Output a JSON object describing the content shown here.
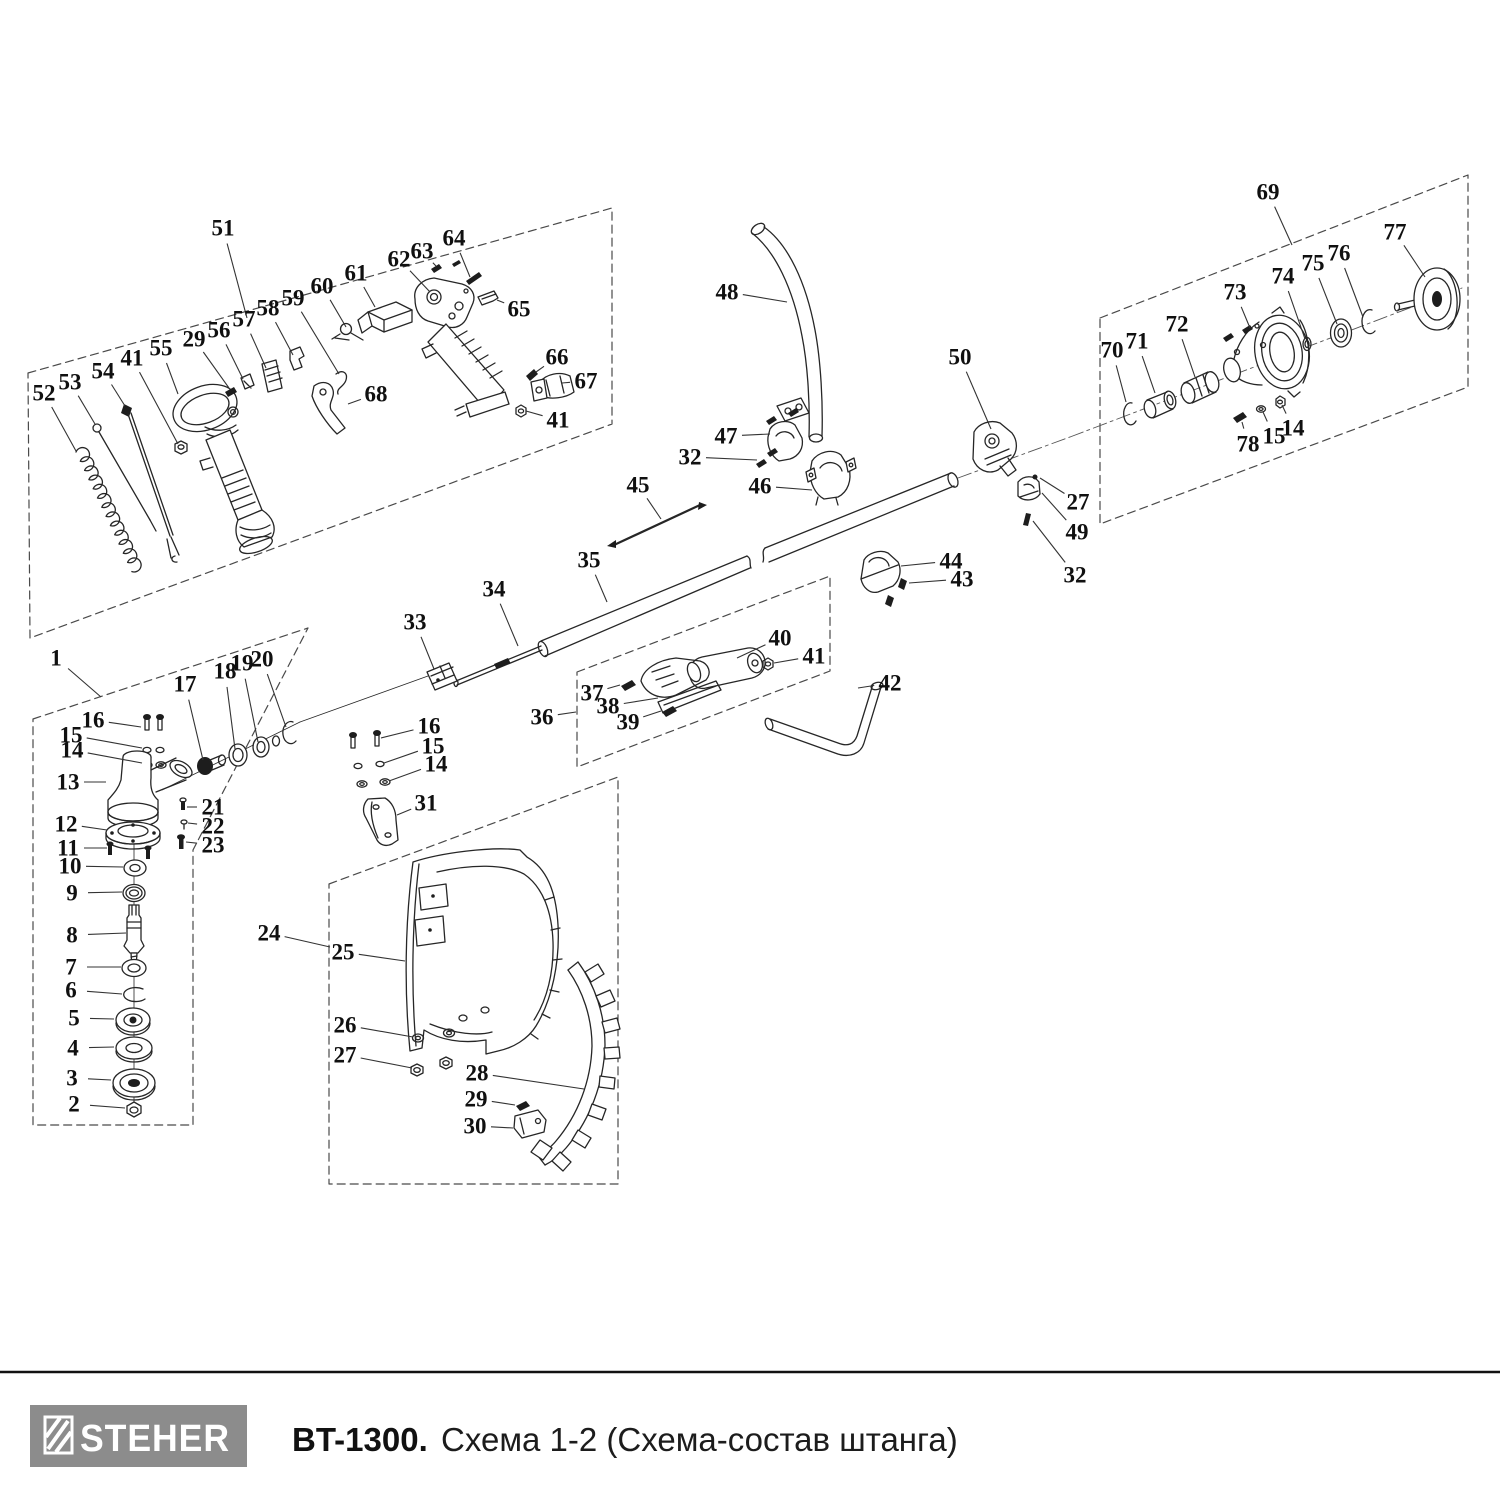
{
  "footer": {
    "brand": "STEHER",
    "model": "BT-1300.",
    "subtitle": "Схема 1-2 (Схема-состав штанга)"
  },
  "colors": {
    "ink": "#262626",
    "label": "#101010",
    "region_dash": "#4a4a4a",
    "logo_bg": "#8c8c8c",
    "logo_fg": "#ffffff",
    "rule": "#111111",
    "background": "#ffffff"
  },
  "diagram": {
    "type": "exploded-parts-diagram",
    "callout_format": [
      "label",
      "x",
      "y",
      "target_x",
      "target_y"
    ],
    "callouts": [
      [
        "51",
        223,
        228,
        247,
        318
      ],
      [
        "52",
        44,
        393,
        76,
        451
      ],
      [
        "53",
        70,
        382,
        95,
        424
      ],
      [
        "54",
        103,
        371,
        125,
        406
      ],
      [
        "41",
        132,
        358,
        178,
        444
      ],
      [
        "55",
        161,
        348,
        178,
        394
      ],
      [
        "29",
        194,
        339,
        229,
        388
      ],
      [
        "56",
        219,
        330,
        243,
        379
      ],
      [
        "57",
        244,
        319,
        266,
        368
      ],
      [
        "58",
        268,
        308,
        293,
        355
      ],
      [
        "59",
        293,
        298,
        339,
        374
      ],
      [
        "60",
        322,
        286,
        346,
        327
      ],
      [
        "61",
        356,
        273,
        375,
        307
      ],
      [
        "62",
        399,
        259,
        430,
        292
      ],
      [
        "63",
        422,
        251,
        436,
        266
      ],
      [
        "64",
        454,
        238,
        470,
        277
      ],
      [
        "65",
        519,
        309,
        497,
        300
      ],
      [
        "66",
        557,
        357,
        536,
        372
      ],
      [
        "67",
        586,
        381,
        562,
        383
      ],
      [
        "41",
        558,
        420,
        526,
        411
      ],
      [
        "68",
        376,
        394,
        348,
        404
      ],
      [
        "48",
        727,
        292,
        787,
        302
      ],
      [
        "47",
        726,
        436,
        770,
        434
      ],
      [
        "32",
        690,
        457,
        757,
        460
      ],
      [
        "46",
        760,
        486,
        812,
        490
      ],
      [
        "45",
        638,
        485,
        661,
        519
      ],
      [
        "35",
        589,
        560,
        607,
        602
      ],
      [
        "34",
        494,
        589,
        518,
        646
      ],
      [
        "33",
        415,
        622,
        434,
        669
      ],
      [
        "44",
        951,
        561,
        901,
        566
      ],
      [
        "43",
        962,
        579,
        909,
        583
      ],
      [
        "50",
        960,
        357,
        991,
        429
      ],
      [
        "27",
        1078,
        502,
        1040,
        478
      ],
      [
        "49",
        1077,
        532,
        1042,
        493
      ],
      [
        "32",
        1075,
        575,
        1033,
        521
      ],
      [
        "36",
        542,
        717,
        576,
        712
      ],
      [
        "37",
        592,
        693,
        620,
        685
      ],
      [
        "38",
        608,
        706,
        658,
        698
      ],
      [
        "39",
        628,
        722,
        661,
        711
      ],
      [
        "40",
        780,
        638,
        737,
        658
      ],
      [
        "41",
        814,
        656,
        774,
        663
      ],
      [
        "42",
        890,
        683,
        858,
        688
      ],
      [
        "69",
        1268,
        192,
        1292,
        245
      ],
      [
        "70",
        1112,
        350,
        1126,
        402
      ],
      [
        "71",
        1137,
        341,
        1155,
        393
      ],
      [
        "72",
        1177,
        324,
        1195,
        377
      ],
      [
        "73",
        1235,
        292,
        1250,
        328
      ],
      [
        "74",
        1283,
        276,
        1305,
        339
      ],
      [
        "75",
        1313,
        263,
        1337,
        324
      ],
      [
        "76",
        1339,
        253,
        1363,
        317
      ],
      [
        "77",
        1395,
        232,
        1425,
        277
      ],
      [
        "78",
        1248,
        444,
        1242,
        422
      ],
      [
        "15",
        1274,
        436,
        1263,
        412
      ],
      [
        "14",
        1293,
        428,
        1282,
        405
      ],
      [
        "1",
        56,
        658,
        101,
        697
      ],
      [
        "16",
        93,
        720,
        141,
        727
      ],
      [
        "15",
        71,
        735,
        142,
        748
      ],
      [
        "14",
        72,
        750,
        142,
        763
      ],
      [
        "13",
        68,
        782,
        106,
        782
      ],
      [
        "12",
        66,
        824,
        107,
        830
      ],
      [
        "11",
        68,
        848,
        107,
        848
      ],
      [
        "10",
        70,
        866,
        123,
        867
      ],
      [
        "9",
        72,
        893,
        122,
        892
      ],
      [
        "8",
        72,
        935,
        126,
        933
      ],
      [
        "7",
        71,
        967,
        121,
        967
      ],
      [
        "6",
        71,
        990,
        122,
        994
      ],
      [
        "5",
        74,
        1018,
        114,
        1019
      ],
      [
        "4",
        73,
        1048,
        114,
        1047
      ],
      [
        "3",
        72,
        1078,
        111,
        1080
      ],
      [
        "2",
        74,
        1104,
        125,
        1108
      ],
      [
        "17",
        185,
        684,
        203,
        760
      ],
      [
        "18",
        225,
        671,
        235,
        749
      ],
      [
        "19",
        242,
        663,
        258,
        742
      ],
      [
        "20",
        262,
        659,
        286,
        727
      ],
      [
        "21",
        213,
        807,
        187,
        807
      ],
      [
        "22",
        213,
        826,
        188,
        823
      ],
      [
        "23",
        213,
        845,
        186,
        842
      ],
      [
        "16",
        429,
        726,
        381,
        738
      ],
      [
        "15",
        433,
        746,
        384,
        763
      ],
      [
        "14",
        436,
        764,
        389,
        781
      ],
      [
        "31",
        426,
        803,
        397,
        815
      ],
      [
        "24",
        269,
        933,
        330,
        947
      ],
      [
        "25",
        343,
        952,
        405,
        961
      ],
      [
        "26",
        345,
        1025,
        413,
        1037
      ],
      [
        "27",
        345,
        1055,
        412,
        1068
      ],
      [
        "28",
        477,
        1073,
        584,
        1089
      ],
      [
        "29",
        476,
        1099,
        515,
        1105
      ],
      [
        "30",
        475,
        1126,
        513,
        1128
      ]
    ]
  }
}
